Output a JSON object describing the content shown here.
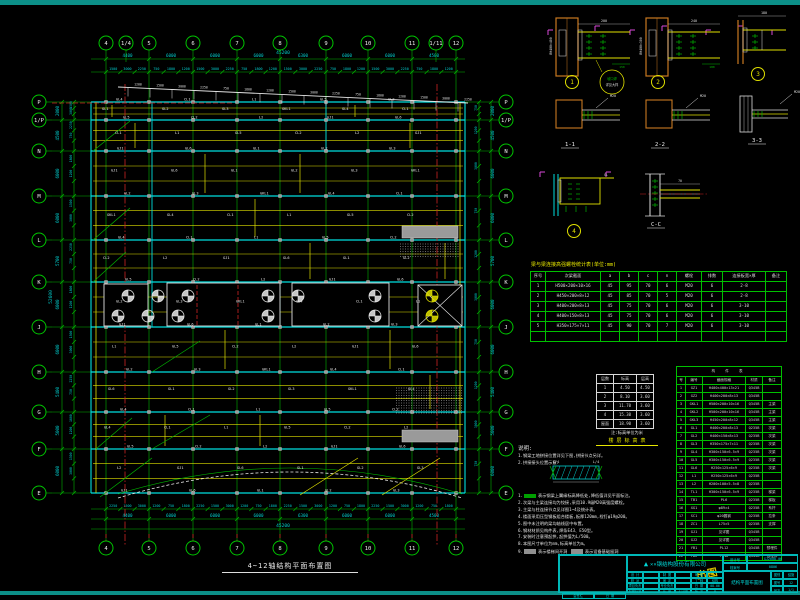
{
  "sheet": {
    "colors": {
      "band": "#0c8f88",
      "grid": "#00b400",
      "beam_main": "#00dede",
      "beam_sec": "#e0e000",
      "dim": "#00cccc",
      "axis_red": "#cc2222",
      "column_orange": "#c87820",
      "magenta": "#d848d8",
      "titleblock": "#00b8b8",
      "text": "#e8e8e8",
      "highlight": "#e8e800"
    }
  },
  "plan": {
    "title": "4~12轴结构平面布置图",
    "top_axes": [
      "4",
      "1/4",
      "5",
      "6",
      "7",
      "8",
      "9",
      "10",
      "11",
      "1/11",
      "12"
    ],
    "bottom_axes": [
      "4",
      "5",
      "6",
      "7",
      "8",
      "9",
      "10",
      "11",
      "12"
    ],
    "side_axes": [
      "P",
      "1/P",
      "N",
      "M",
      "L",
      "K",
      "J",
      "H",
      "G",
      "F",
      "E"
    ],
    "dims": {
      "top_major": [
        "4400",
        "6000",
        "6000",
        "6000",
        "6300",
        "6000",
        "6000",
        "4500"
      ],
      "top_total": "45200",
      "left_major": [
        "2000",
        "4500",
        "6000",
        "6000",
        "5700",
        "6000",
        "6000",
        "5400",
        "5000",
        "6000"
      ],
      "left_total": "52600",
      "fine_pool": [
        "1500",
        "3000",
        "2250",
        "750",
        "1800",
        "1200"
      ]
    },
    "beam_labels_pool": [
      "GL1",
      "GL2",
      "GL3",
      "GKL1",
      "GL4",
      "CL1",
      "L1",
      "GL5",
      "CL2",
      "L2",
      "GJ1",
      "GL6"
    ]
  },
  "details": {
    "callouts": [
      "1",
      "2",
      "3",
      "4"
    ],
    "sections": [
      "1-1",
      "2-2",
      "3-3",
      "C-C"
    ],
    "dims_pool": [
      "200",
      "240",
      "150",
      "180"
    ],
    "col_labels": [
      "BH400×400",
      "BH400×300"
    ],
    "callout_lines": [
      "坡口焊",
      "详见大样"
    ],
    "beam_mark": "GL",
    "bolt_mark": "M20"
  },
  "bolt_table": {
    "title": "梁与梁连接高强螺栓统计表(单位:mm)",
    "headers": [
      "序号",
      "次梁截面",
      "a",
      "b",
      "c",
      "n",
      "螺栓",
      "排数",
      "连接板宽×厚",
      "备注"
    ],
    "rows": [
      [
        "1",
        "H500×200×10×16",
        "45",
        "95",
        "70",
        "6",
        "M20",
        "6",
        "2-8",
        ""
      ],
      [
        "2",
        "H450×200×8×12",
        "45",
        "85",
        "70",
        "5",
        "M20",
        "6",
        "2-8",
        ""
      ],
      [
        "3",
        "H400×200×8×13",
        "45",
        "75",
        "70",
        "6",
        "M20",
        "6",
        "3-10",
        ""
      ],
      [
        "4",
        "H400×150×8×13",
        "45",
        "75",
        "70",
        "6",
        "M20",
        "6",
        "3-10",
        ""
      ],
      [
        "5",
        "H350×175×7×11",
        "45",
        "90",
        "70",
        "7",
        "M20",
        "6",
        "3-10",
        ""
      ]
    ]
  },
  "level_table": {
    "headers": [
      "层数",
      "标高",
      "层高"
    ],
    "rows": [
      [
        "1",
        "4.50",
        "4.50"
      ],
      [
        "2",
        "8.10",
        "3.60"
      ],
      [
        "3",
        "11.70",
        "3.60"
      ],
      [
        "4",
        "15.30",
        "3.60"
      ],
      [
        "屋面",
        "18.90",
        "3.60"
      ]
    ],
    "caption_white": "注:标高单位为米",
    "caption_yellow": "楼 层 标 高 表"
  },
  "member_table": {
    "title": "构 件 表",
    "headers": [
      "号",
      "编号",
      "截面规格",
      "材质",
      "备注"
    ],
    "rows": [
      [
        "1",
        "GZ1",
        "H400×400×13×21",
        "Q345B",
        ""
      ],
      [
        "2",
        "GZ2",
        "H400×200×8×13",
        "Q345B",
        ""
      ],
      [
        "3",
        "GKL1",
        "H500×200×10×16",
        "Q345B",
        "主梁"
      ],
      [
        "4",
        "GKL2",
        "H500×200×10×16",
        "Q345B",
        "主梁"
      ],
      [
        "5",
        "GKL3",
        "H450×200×8×12",
        "Q345B",
        "主梁"
      ],
      [
        "6",
        "GL1",
        "H400×200×8×13",
        "Q235B",
        "次梁"
      ],
      [
        "7",
        "GL2",
        "H400×150×8×13",
        "Q235B",
        "次梁"
      ],
      [
        "8",
        "GL3",
        "H350×175×7×11",
        "Q235B",
        "次梁"
      ],
      [
        "9",
        "GL4",
        "H300×150×6.5×9",
        "Q235B",
        "次梁"
      ],
      [
        "10",
        "GL5",
        "H300×150×6.5×9",
        "Q235B",
        "次梁"
      ],
      [
        "11",
        "GL6",
        "H250×125×6×9",
        "Q235B",
        "次梁"
      ],
      [
        "12",
        "L1",
        "H250×125×6×9",
        "Q235B",
        ""
      ],
      [
        "13",
        "L2",
        "H200×100×5.5×8",
        "Q235B",
        ""
      ],
      [
        "14",
        "TL1",
        "H300×150×6.5×9",
        "Q235B",
        "梯梁"
      ],
      [
        "15",
        "TB1",
        "PL6",
        "Q235B",
        "梯板"
      ],
      [
        "16",
        "XG1",
        "φ89×4",
        "Q235B",
        "系杆"
      ],
      [
        "17",
        "SC1",
        "φ20圆钢",
        "Q235B",
        "拉条"
      ],
      [
        "18",
        "ZC1",
        "L75×5",
        "Q235B",
        "支撑"
      ],
      [
        "19",
        "GJ1",
        "见详图",
        "Q345B",
        ""
      ],
      [
        "20",
        "GJ2",
        "见详图",
        "Q345B",
        ""
      ],
      [
        "21",
        "YB1",
        "PL12",
        "Q345B",
        "预埋件"
      ],
      [
        "22",
        "YB2",
        "PL16",
        "Q345B",
        "预埋件"
      ]
    ]
  },
  "notes": {
    "heading": "说明:",
    "pre": [
      "1.钢梁工地拼接位置详见下图,拼接节点另详。",
      "2.拼接接头位置示意:"
    ],
    "splice_labels": [
      "L/4",
      "L/4"
    ],
    "items": [
      "表示钢梁上翼缘标高降低处,降低值详见平面标注。",
      "次梁与主梁连接均为铰接,采用10.9级M20高强度螺栓。",
      "主梁与柱连接节点见详图1~4及统计表。",
      "楼面采用压型钢板组合楼板,板厚120mm,栓钉φ19@200。",
      "图中未注明的梁均轴线居中布置。",
      "钢材材质见构件表,焊条E43、E50型。",
      "安装时注意预起拱,起拱值为L/500。",
      "本图尺寸单位为mm,标高单位为m。"
    ],
    "legend_prefix": "9.",
    "legend": [
      {
        "box": "#909090",
        "text": "表示楼梯间开洞"
      },
      {
        "box": "#909090",
        "text": "表示设备基础留洞"
      }
    ]
  },
  "titleblock": {
    "company": "××钢结构股份有限公司",
    "logo": "▲",
    "grid": [
      [
        "设 计",
        "",
        "制 图",
        "",
        "审 核",
        ""
      ],
      [
        "校 对",
        "",
        "审 定",
        "",
        "工 种",
        "结构"
      ],
      [
        "项目负责",
        "",
        "专业负责",
        "",
        "日 期",
        "08.06"
      ],
      [
        "制图标准",
        "",
        "比 例",
        "1:150",
        "版 次",
        "A"
      ]
    ],
    "proj_rows": [
      [
        "设计号",
        "GJ2008-06"
      ],
      [
        "档案号",
        "0806"
      ]
    ],
    "title_cell": "结构平面布置图",
    "right_rows": [
      [
        "图别",
        "结施"
      ],
      [
        "图号",
        "12"
      ],
      [
        "张次",
        "1/1"
      ]
    ],
    "bottom_cells": [
      "会签栏",
      "日 期"
    ],
    "stamp": "出图"
  }
}
